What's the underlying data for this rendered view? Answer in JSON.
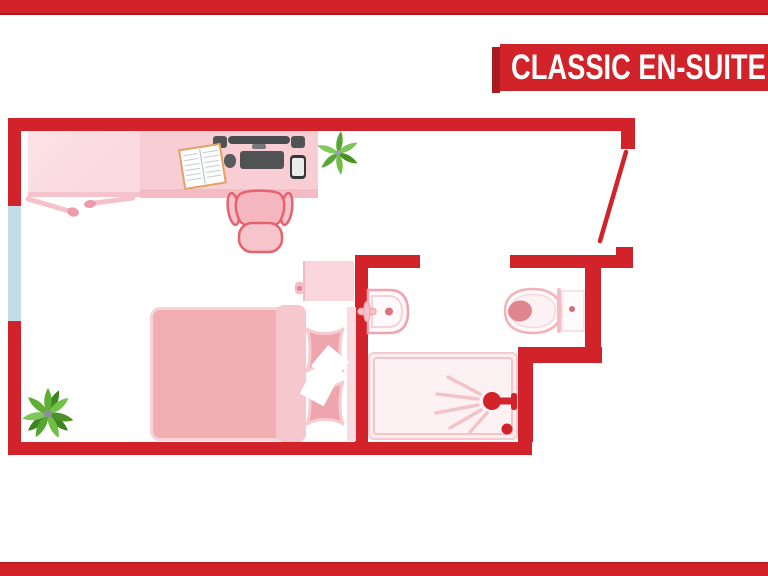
{
  "banner": {
    "title": "CLASSIC EN-SUITE"
  },
  "colors": {
    "accent_red": "#D2232A",
    "accent_red_dark": "#A81B21",
    "window_blue": "#C2DDE5",
    "desk_pink": "#F8CDD4",
    "bed_pink": "#F1AFB4",
    "pillow_pink": "#EFA5AD",
    "fixture_outline": "#EFA5AF",
    "plant_green": "#6FBE45",
    "device_gray": "#4B4C4E"
  },
  "plan": {
    "rooms": [
      {
        "name": "bedroom"
      },
      {
        "name": "en-suite bathroom"
      }
    ],
    "furniture": [
      "desk",
      "desk-return",
      "office-chair",
      "monitor",
      "speakers",
      "keyboard",
      "mouse",
      "smartphone",
      "open-notebook",
      "potted-plant",
      "bed",
      "pillows",
      "duvet",
      "nightstand",
      "window",
      "entry-door",
      "bathroom-door",
      "washbasin",
      "toilet",
      "shower"
    ]
  }
}
